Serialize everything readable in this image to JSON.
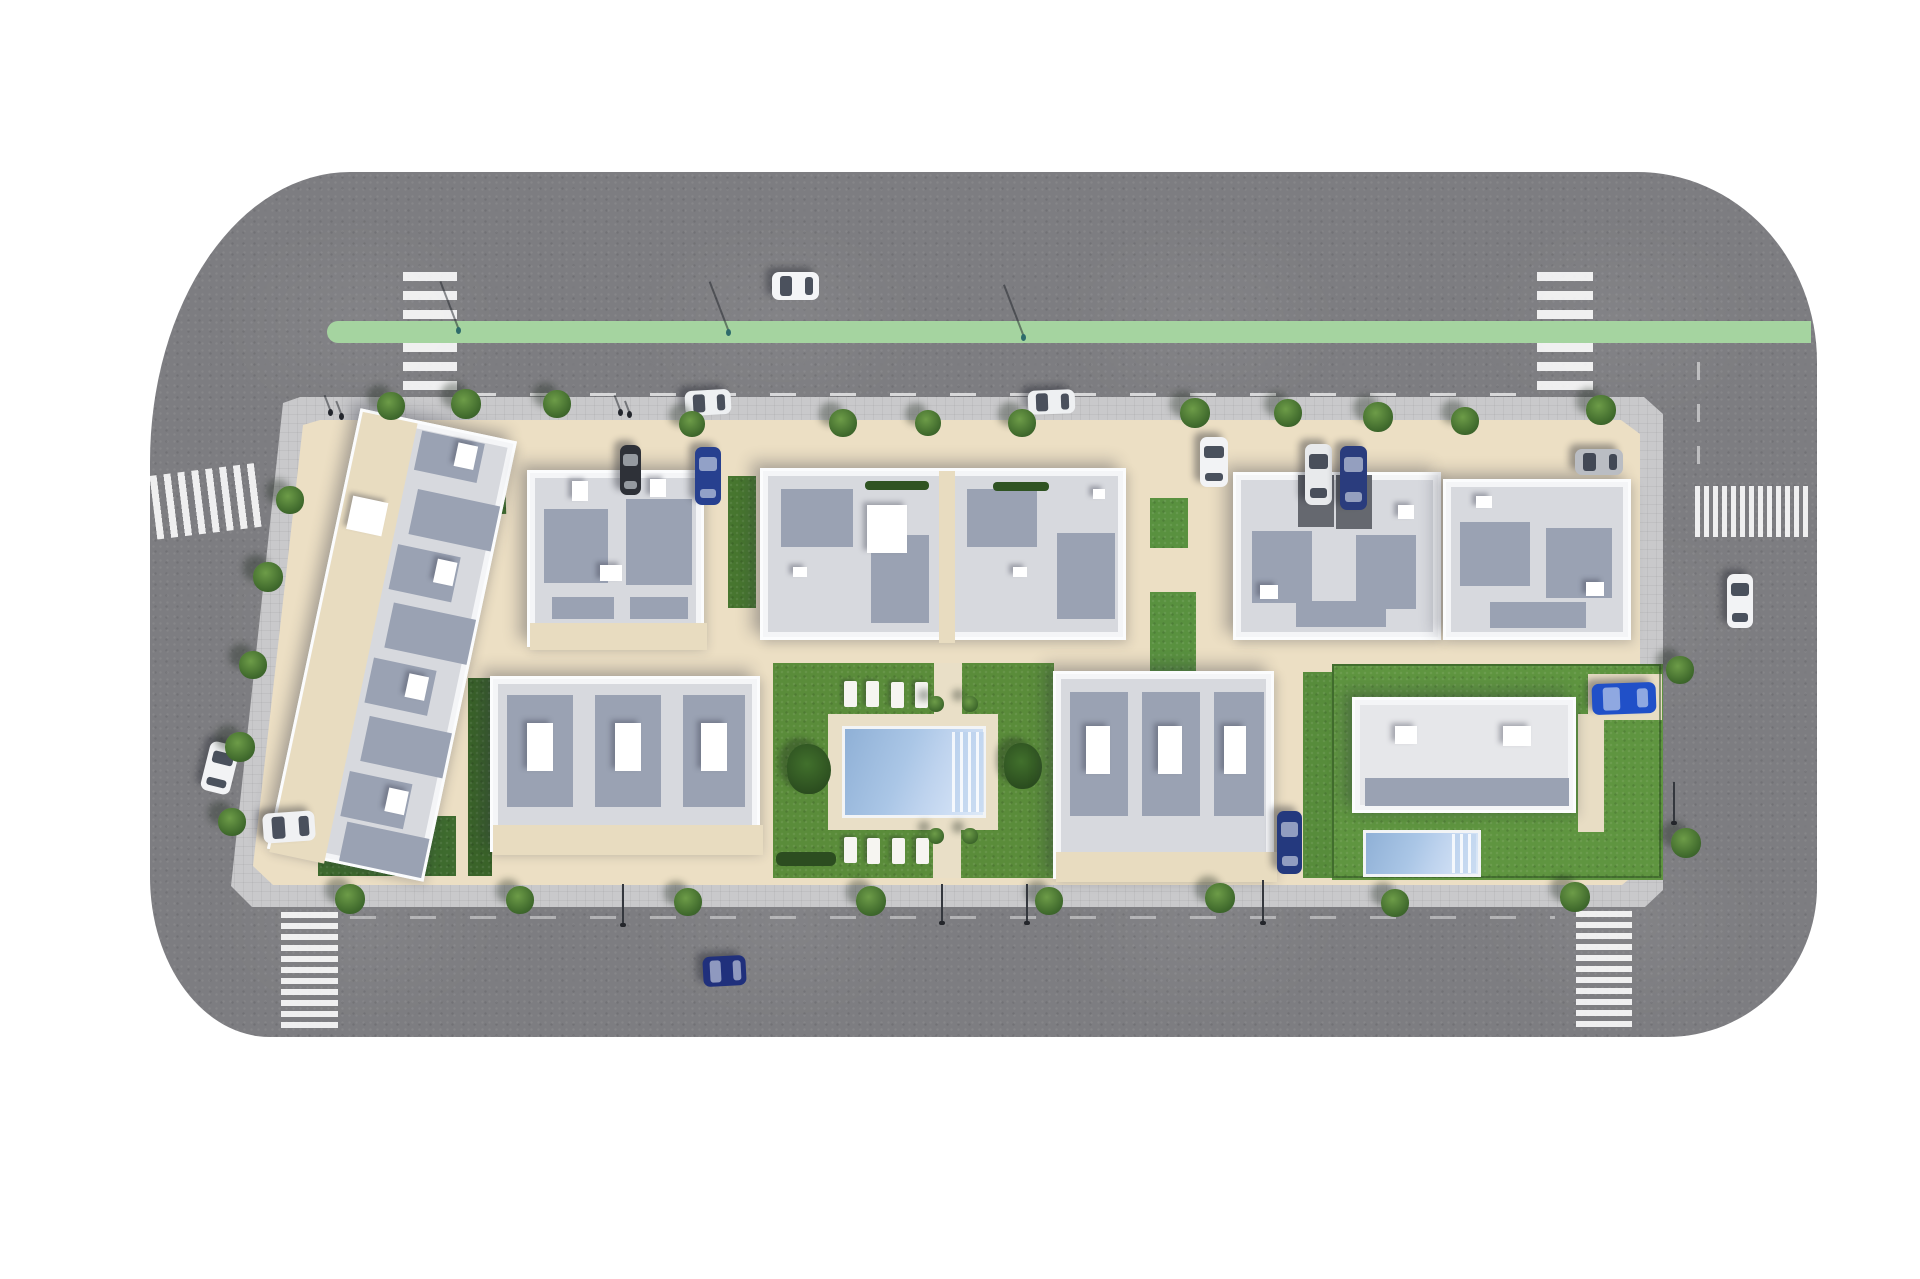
{
  "meta": {
    "title": "Aerial 3D site plan render of a residential development block",
    "type": "architectural-render"
  },
  "palette": {
    "background": "#ffffff",
    "asphalt": "#7d7d81",
    "asphalt_edge": "#747478",
    "bike_lane_green": "#a5d4a0",
    "sidewalk": "#c9c9cb",
    "block_beige": "#ecdfc4",
    "terrace_beige": "#e8dcc0",
    "building_white": "#f4f5f7",
    "roof_gray": "#d7d9de",
    "roof_shade_slate": "#9aa2b3",
    "lawn_dark": "#3f6b2e",
    "lawn_mid": "#5a8c3a",
    "lawn_bright": "#5f9540",
    "pool_blue": "#aac6e6",
    "crosswalk_white": "rgba(255,255,255,0.88)",
    "driveway_dark": "#5d5e63",
    "hedge_dark": "#2f5322"
  },
  "scene": {
    "size": {
      "w": 1920,
      "h": 1279
    },
    "road": {
      "x": 150,
      "y": 172,
      "w": 1667,
      "h": 865,
      "color": "#7d7d81",
      "radius": "200px 180px 150px 120px / 290px 190px 150px 160px"
    },
    "green_lane": {
      "x": 327,
      "y": 321,
      "w": 1484,
      "h": 22,
      "color": "#a5d4a0",
      "cap_radius": 11
    },
    "lane_dashes": [
      [
        470,
        393,
        1055,
        3,
        "h",
        0.7
      ],
      [
        350,
        916,
        1205,
        3,
        "h",
        0.4
      ],
      [
        1697,
        362,
        3,
        112,
        "v",
        0.5
      ]
    ],
    "crosswalks": [
      [
        403,
        272,
        54,
        49,
        "h",
        0,
        9,
        10
      ],
      [
        403,
        343,
        54,
        55,
        "h",
        0,
        9,
        10
      ],
      [
        1537,
        272,
        56,
        49,
        "h",
        0,
        9,
        10
      ],
      [
        1537,
        343,
        56,
        55,
        "h",
        0,
        9,
        10
      ],
      [
        153,
        469,
        110,
        64,
        "v",
        -7,
        7,
        7
      ],
      [
        281,
        912,
        57,
        117,
        "h",
        0,
        6,
        5
      ],
      [
        1576,
        911,
        56,
        118,
        "h",
        0,
        6,
        5
      ],
      [
        1695,
        486,
        113,
        51,
        "v",
        0,
        5,
        4
      ]
    ],
    "driveway": {
      "x": 1105,
      "y": 425,
      "w": 123,
      "h": 156,
      "thickness": 33,
      "color": "#5d5e63",
      "corner": 58
    },
    "driveway_pads": [
      [
        505,
        398,
        30,
        22
      ],
      [
        1497,
        398,
        42,
        22
      ]
    ],
    "block": {
      "sidewalk_color": "#c9c9cb",
      "interior_color": "#ecdfc4",
      "sidewalk_poly": [
        [
          300,
          397
        ],
        [
          1644,
          397
        ],
        [
          1663,
          414
        ],
        [
          1663,
          890
        ],
        [
          1645,
          907
        ],
        [
          252,
          907
        ],
        [
          231,
          886
        ],
        [
          283,
          403
        ]
      ],
      "interior_poly": [
        [
          320,
          420
        ],
        [
          1621,
          420
        ],
        [
          1640,
          434
        ],
        [
          1640,
          870
        ],
        [
          1622,
          885
        ],
        [
          273,
          885
        ],
        [
          253,
          866
        ],
        [
          303,
          425
        ]
      ]
    },
    "lawns": [
      [
        383,
        443,
        122,
        73,
        "#41702f",
        -2
      ],
      [
        318,
        816,
        138,
        60,
        "#3e6b2e",
        0
      ],
      [
        468,
        678,
        24,
        198,
        "#3a6329",
        0
      ],
      [
        728,
        476,
        28,
        132,
        "#47762f",
        0
      ],
      [
        773,
        663,
        281,
        215,
        "#5a8c3a",
        0
      ],
      [
        1150,
        592,
        46,
        88,
        "#59913f",
        0
      ],
      [
        1150,
        498,
        38,
        50,
        "#59913f",
        0
      ],
      [
        1303,
        672,
        50,
        206,
        "#578c3b",
        0
      ],
      [
        1332,
        664,
        331,
        216,
        "#5f9540",
        0
      ],
      [
        1578,
        714,
        26,
        118,
        "#e8ddc4",
        0
      ],
      [
        1588,
        674,
        74,
        46,
        "#e8ddc4",
        0
      ]
    ],
    "garden": {
      "deck": [
        828,
        714,
        170,
        116,
        "#e9dfc7"
      ],
      "pool": [
        842,
        726,
        144,
        92
      ],
      "pool_steps": [
        952,
        732,
        32,
        80
      ],
      "paths": [
        [
          934,
          663,
          28,
          53
        ],
        [
          933,
          826,
          28,
          52
        ]
      ],
      "lounger_size": [
        13,
        26
      ],
      "loungers": [
        [
          844,
          681
        ],
        [
          866,
          681
        ],
        [
          891,
          682
        ],
        [
          915,
          682
        ],
        [
          844,
          837
        ],
        [
          867,
          838
        ],
        [
          892,
          838
        ],
        [
          916,
          838
        ]
      ],
      "bushes": [
        [
          787,
          744,
          44,
          50
        ],
        [
          1004,
          743,
          38,
          46
        ]
      ],
      "small_trees": [
        [
          936,
          704,
          8
        ],
        [
          970,
          704,
          8
        ],
        [
          936,
          836,
          8
        ],
        [
          970,
          836,
          8
        ]
      ],
      "hedge": [
        776,
        852,
        60,
        14,
        "#2c4d20"
      ]
    },
    "villa_pool": {
      "pool": [
        1363,
        830,
        118,
        47
      ],
      "steps": [
        1452,
        834,
        24,
        39
      ]
    },
    "roof_hedges": [
      [
        865,
        481,
        64,
        9
      ],
      [
        993,
        482,
        56,
        9
      ]
    ],
    "buildings": [
      {
        "name": "townhouse-row",
        "x": 312,
        "y": 420,
        "w": 160,
        "h": 450,
        "rot": 12,
        "beiges": [
          [
            0,
            0,
            56,
            450
          ]
        ],
        "shades": [
          [
            62,
            6,
            64,
            40
          ],
          [
            70,
            64,
            84,
            46
          ],
          [
            62,
            122,
            64,
            46
          ],
          [
            70,
            180,
            84,
            46
          ],
          [
            62,
            238,
            64,
            46
          ],
          [
            70,
            296,
            84,
            46
          ],
          [
            62,
            354,
            64,
            46
          ],
          [
            70,
            404,
            84,
            40
          ]
        ],
        "whites": [
          [
            8,
            84,
            36,
            34
          ],
          [
            100,
            10,
            20,
            24
          ],
          [
            104,
            128,
            20,
            24
          ],
          [
            100,
            246,
            20,
            24
          ],
          [
            104,
            362,
            20,
            24
          ]
        ]
      },
      {
        "name": "building-top-left",
        "x": 527,
        "y": 470,
        "w": 177,
        "h": 177,
        "beiges": [
          [
            0,
            150,
            177,
            27
          ]
        ],
        "shades": [
          [
            14,
            36,
            64,
            74
          ],
          [
            96,
            26,
            66,
            86
          ],
          [
            22,
            124,
            62,
            22
          ],
          [
            100,
            124,
            58,
            22
          ]
        ],
        "whites": [
          [
            42,
            8,
            16,
            20
          ],
          [
            120,
            6,
            16,
            18
          ],
          [
            70,
            92,
            22,
            16
          ]
        ]
      },
      {
        "name": "building-central",
        "x": 760,
        "y": 468,
        "w": 366,
        "h": 172,
        "beiges": [
          [
            176,
            0,
            16,
            172
          ]
        ],
        "shades": [
          [
            18,
            18,
            72,
            58
          ],
          [
            108,
            64,
            58,
            88
          ],
          [
            204,
            18,
            70,
            58
          ],
          [
            294,
            62,
            58,
            86
          ]
        ],
        "whites": [
          [
            104,
            34,
            40,
            48
          ],
          [
            30,
            96,
            14,
            10
          ],
          [
            250,
            96,
            14,
            10
          ],
          [
            330,
            18,
            12,
            10
          ]
        ]
      },
      {
        "name": "building-top-right-1",
        "x": 1233,
        "y": 472,
        "w": 208,
        "h": 168,
        "darks": [
          [
            62,
            0,
            36,
            52
          ],
          [
            100,
            0,
            36,
            54
          ]
        ],
        "shades": [
          [
            16,
            56,
            60,
            72
          ],
          [
            120,
            60,
            60,
            74
          ],
          [
            60,
            126,
            90,
            26
          ]
        ],
        "whites": [
          [
            24,
            110,
            18,
            14
          ],
          [
            162,
            30,
            16,
            14
          ]
        ]
      },
      {
        "name": "building-top-right-2",
        "x": 1443,
        "y": 479,
        "w": 188,
        "h": 161,
        "shades": [
          [
            14,
            40,
            70,
            64
          ],
          [
            100,
            46,
            66,
            70
          ],
          [
            44,
            120,
            96,
            26
          ]
        ],
        "whites": [
          [
            30,
            14,
            16,
            12
          ],
          [
            140,
            100,
            18,
            14
          ]
        ]
      },
      {
        "name": "building-bottom-left",
        "x": 490,
        "y": 676,
        "w": 270,
        "h": 176,
        "beiges": [
          [
            0,
            146,
            270,
            30
          ]
        ],
        "shades": [
          [
            14,
            16,
            66,
            112
          ],
          [
            102,
            16,
            66,
            112
          ],
          [
            190,
            16,
            62,
            112
          ]
        ],
        "whites": [
          [
            34,
            44,
            26,
            48
          ],
          [
            122,
            44,
            26,
            48
          ],
          [
            208,
            44,
            26,
            48
          ]
        ]
      },
      {
        "name": "building-bottom-right",
        "x": 1053,
        "y": 671,
        "w": 221,
        "h": 208,
        "beiges": [
          [
            0,
            178,
            221,
            30
          ]
        ],
        "shades": [
          [
            14,
            18,
            58,
            124
          ],
          [
            86,
            18,
            58,
            124
          ],
          [
            158,
            18,
            50,
            124
          ]
        ],
        "whites": [
          [
            30,
            52,
            24,
            48
          ],
          [
            102,
            52,
            24,
            48
          ],
          [
            168,
            52,
            22,
            48
          ]
        ]
      },
      {
        "name": "villa",
        "x": 1352,
        "y": 697,
        "w": 224,
        "h": 116,
        "roof": "#e6e7ea",
        "shades": [
          [
            10,
            78,
            204,
            28
          ]
        ],
        "whites": [
          [
            40,
            26,
            22,
            18
          ],
          [
            148,
            26,
            28,
            20
          ]
        ]
      }
    ],
    "cars": [
      [
        772,
        272,
        47,
        28,
        "#f4f5f7",
        0,
        "car-white-top-road"
      ],
      [
        685,
        390,
        46,
        25,
        "#eef0f2",
        -3,
        "car-white-parked-top-1"
      ],
      [
        1028,
        390,
        47,
        24,
        "#eef0f2",
        -2,
        "car-white-parked-top-2"
      ],
      [
        1200,
        437,
        28,
        50,
        "#f2f3f5",
        0,
        "car-white-driveway"
      ],
      [
        620,
        445,
        21,
        50,
        "#2e3138",
        0,
        "van-dark-parked"
      ],
      [
        695,
        447,
        26,
        58,
        "#27408f",
        0,
        "car-blue-parked-mid"
      ],
      [
        1305,
        444,
        27,
        61,
        "#e8eaec",
        0,
        "car-white-parked-bay"
      ],
      [
        1340,
        446,
        27,
        64,
        "#2a3c7d",
        0,
        "van-blue-parked-bay"
      ],
      [
        1575,
        449,
        48,
        26,
        "#babdc3",
        0,
        "car-silver-top-right"
      ],
      [
        205,
        743,
        30,
        50,
        "#f2f3f5",
        14,
        "car-white-left-road"
      ],
      [
        263,
        812,
        52,
        30,
        "#f0f1f3",
        -4,
        "car-white-parked-left"
      ],
      [
        703,
        956,
        43,
        30,
        "#20307c",
        -3,
        "car-blue-bottom-road"
      ],
      [
        1727,
        574,
        26,
        54,
        "#f2f3f5",
        0,
        "car-white-right-road"
      ],
      [
        1277,
        811,
        25,
        63,
        "#24397e",
        0,
        "car-blue-parked-right"
      ],
      [
        1592,
        683,
        64,
        31,
        "#2050c8",
        -2,
        "car-blue-villa"
      ]
    ],
    "trees": [
      [
        391,
        406,
        14
      ],
      [
        466,
        404,
        15
      ],
      [
        557,
        404,
        14
      ],
      [
        692,
        424,
        13
      ],
      [
        843,
        423,
        14
      ],
      [
        928,
        423,
        13
      ],
      [
        1022,
        423,
        14
      ],
      [
        1195,
        413,
        15
      ],
      [
        1288,
        413,
        14
      ],
      [
        1378,
        417,
        15
      ],
      [
        1465,
        421,
        14
      ],
      [
        1601,
        410,
        15
      ],
      [
        290,
        500,
        14
      ],
      [
        268,
        577,
        15
      ],
      [
        253,
        665,
        14
      ],
      [
        240,
        747,
        15
      ],
      [
        232,
        822,
        14
      ],
      [
        350,
        899,
        15
      ],
      [
        520,
        900,
        14
      ],
      [
        688,
        902,
        14
      ],
      [
        871,
        901,
        15
      ],
      [
        1049,
        901,
        14
      ],
      [
        1220,
        898,
        15
      ],
      [
        1395,
        903,
        14
      ],
      [
        1575,
        897,
        15
      ],
      [
        1680,
        670,
        14
      ],
      [
        1686,
        843,
        15
      ]
    ],
    "lights": [
      [
        622,
        884,
        42
      ],
      [
        941,
        884,
        40
      ],
      [
        1026,
        884,
        40
      ],
      [
        1262,
        880,
        44
      ],
      [
        1673,
        782,
        42
      ]
    ],
    "people": [
      [
        728,
        332,
        "#2e6b6b",
        54
      ],
      [
        1023,
        337,
        "#2e6b6b",
        56
      ],
      [
        458,
        330,
        "#2e6b6b",
        52
      ],
      [
        330,
        412,
        "#23262d",
        18
      ],
      [
        341,
        416,
        "#23262d",
        16
      ],
      [
        620,
        412,
        "#23262d",
        18
      ],
      [
        629,
        414,
        "#23262d",
        14
      ]
    ]
  }
}
